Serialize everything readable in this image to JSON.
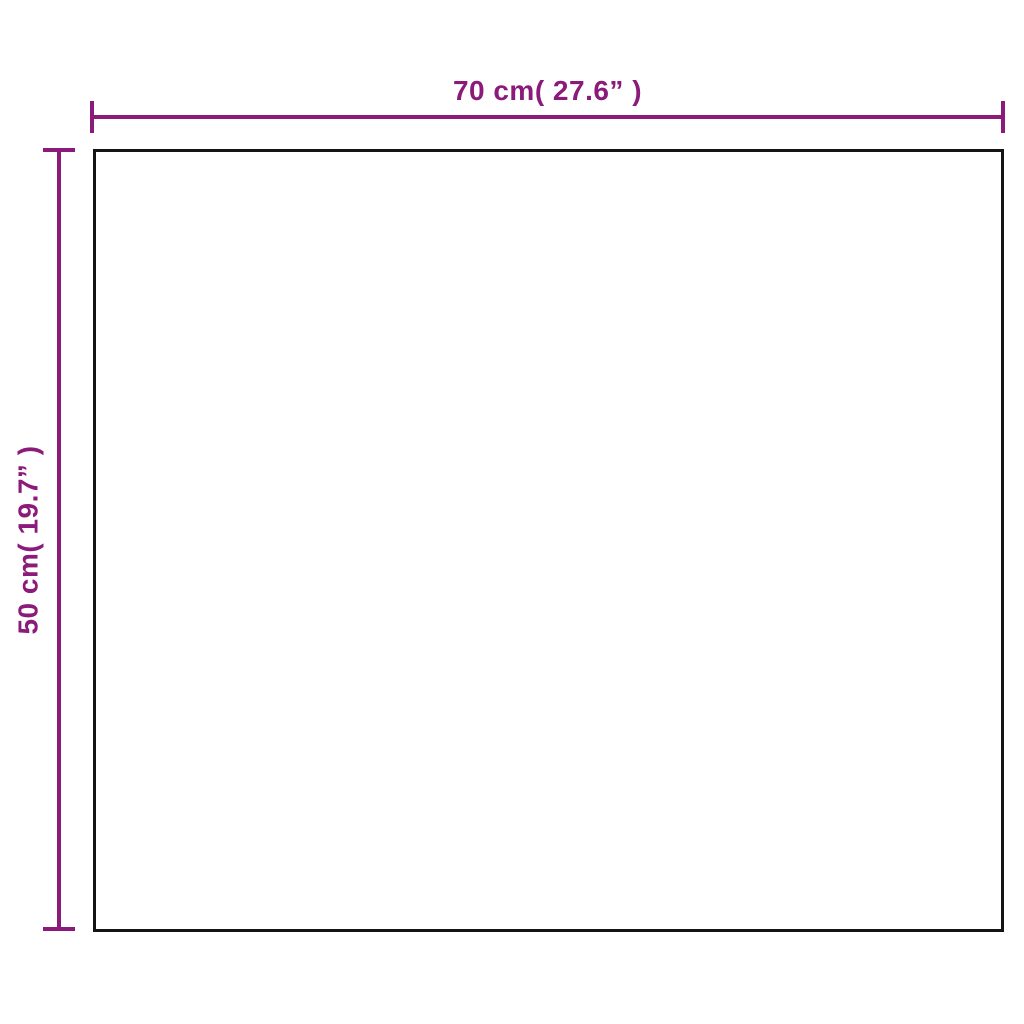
{
  "diagram": {
    "type": "product-dimension-diagram",
    "shape": "rectangle",
    "width_label": "70 cm( 27.6”  )",
    "height_label": "50 cm( 19.7”  )",
    "width_cm": 70,
    "height_cm": 50,
    "width_inches": 27.6,
    "height_inches": 19.7,
    "colors": {
      "accent": "#8b1a7b",
      "outline": "#141414",
      "background": "#ffffff"
    }
  }
}
